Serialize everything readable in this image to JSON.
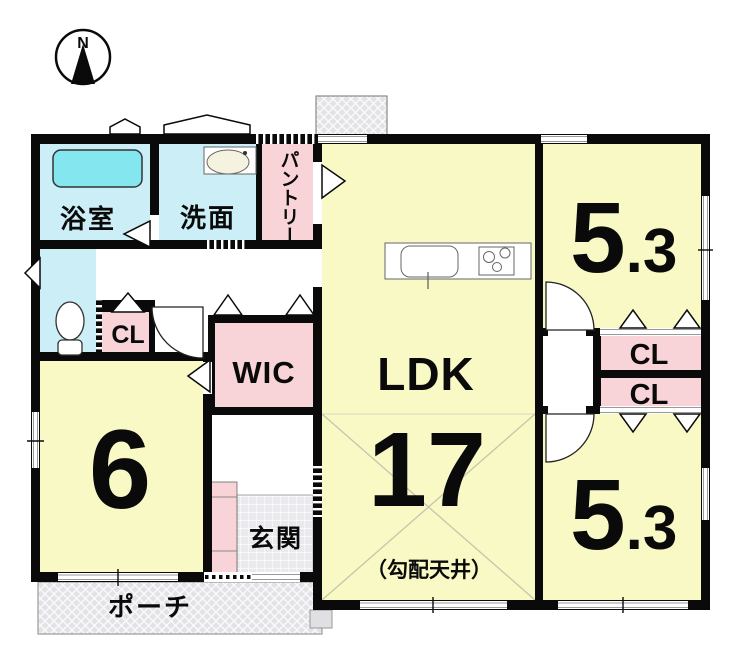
{
  "compass": {
    "north_label": "N"
  },
  "rooms": {
    "bathroom": {
      "label": "浴室"
    },
    "washroom": {
      "label": "洗面"
    },
    "pantry": {
      "label": "パントリー"
    },
    "closet_hall": {
      "label": "CL"
    },
    "wic": {
      "label": "WIC"
    },
    "bedroom_west": {
      "size_label": "6"
    },
    "entrance": {
      "label": "玄関"
    },
    "porch": {
      "label": "ポーチ"
    },
    "ldk": {
      "label": "LDK",
      "size_label": "17",
      "note": "（勾配天井）"
    },
    "bedroom_ne": {
      "size_main": "5",
      "size_decimal": ".3"
    },
    "closet_ne": {
      "label": "CL"
    },
    "closet_se": {
      "label": "CL"
    },
    "bedroom_se": {
      "size_main": "5",
      "size_decimal": ".3"
    }
  },
  "colors": {
    "wall": "#0a0a0a",
    "room_yellow": "#f9f9c6",
    "room_cyan": "#cbeef7",
    "bathtub_cyan": "#84e6ef",
    "closet_pink": "#f8d3d8",
    "porch_gray": "#e3e3e7",
    "tile_gray": "#eaeaee",
    "note_gray": "#444444"
  }
}
